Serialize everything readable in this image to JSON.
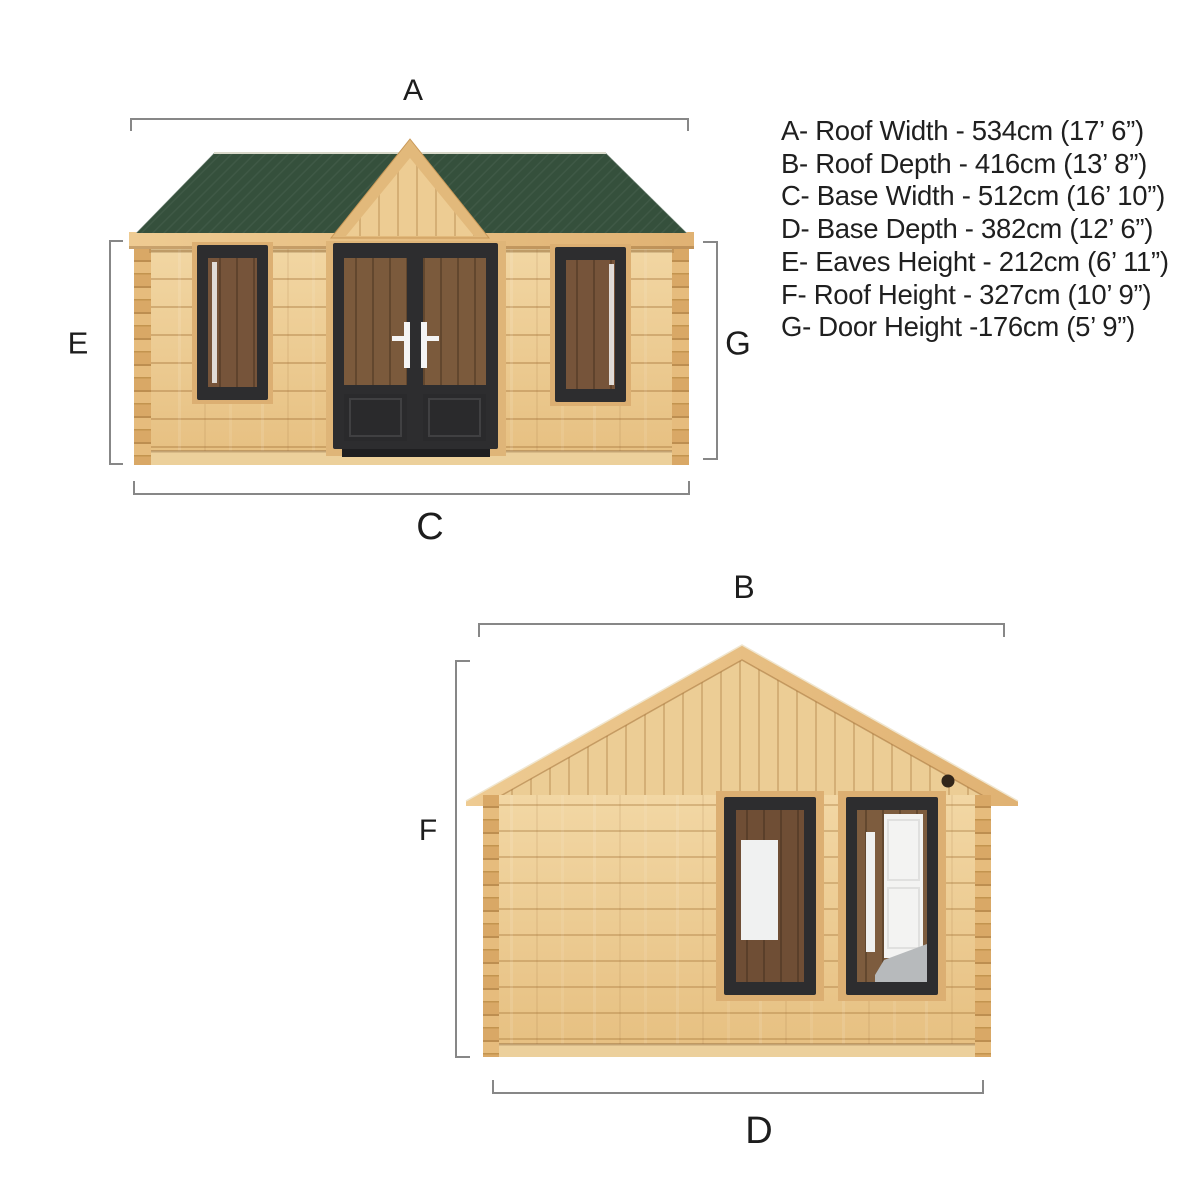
{
  "diagram": {
    "title": "Log cabin dimension diagram (front and side elevations)",
    "views": {
      "front_elevation": "front view with green felt roof, centre gable, double doors and two windows",
      "side_elevation": "gable end view with two windows"
    },
    "legend": {
      "items": [
        {
          "letter": "A",
          "measure": "Roof Width",
          "cm": 534,
          "imperial": "17’ 6”",
          "text": "A- Roof Width - 534cm (17’ 6”)"
        },
        {
          "letter": "B",
          "measure": "Roof Depth",
          "cm": 416,
          "imperial": "13’ 8”",
          "text": "B- Roof Depth - 416cm (13’ 8”)"
        },
        {
          "letter": "C",
          "measure": "Base Width",
          "cm": 512,
          "imperial": "16’ 10”",
          "text": "C- Base Width - 512cm (16’ 10”)"
        },
        {
          "letter": "D",
          "measure": "Base Depth",
          "cm": 382,
          "imperial": "12’ 6”",
          "text": "D- Base Depth - 382cm (12’ 6”)"
        },
        {
          "letter": "E",
          "measure": "Eaves Height",
          "cm": 212,
          "imperial": "6’ 11”",
          "text": "E- Eaves Height - 212cm (6’ 11”)"
        },
        {
          "letter": "F",
          "measure": "Roof Height",
          "cm": 327,
          "imperial": "10’ 9”",
          "text": "F- Roof Height - 327cm (10’ 9”)"
        },
        {
          "letter": "G",
          "measure": "Door Height",
          "cm": 176,
          "imperial": "5’ 9”",
          "text": "G- Door Height -176cm (5’ 9”)"
        }
      ]
    },
    "colors": {
      "background": "#ffffff",
      "roof_felt_green": "#35503c",
      "timber_light": "#f0d3a0",
      "timber_mid": "#e7c285",
      "timber_dark": "#c99a5b",
      "joinery_dark_frame": "#2d2d2f",
      "glass_interior_brown": "#7a573a",
      "interior_white_door": "#f3f3f2",
      "interior_grey_floor": "#b7babc",
      "dimension_line_grey": "#878787",
      "label_text": "#1d1d1d"
    }
  }
}
